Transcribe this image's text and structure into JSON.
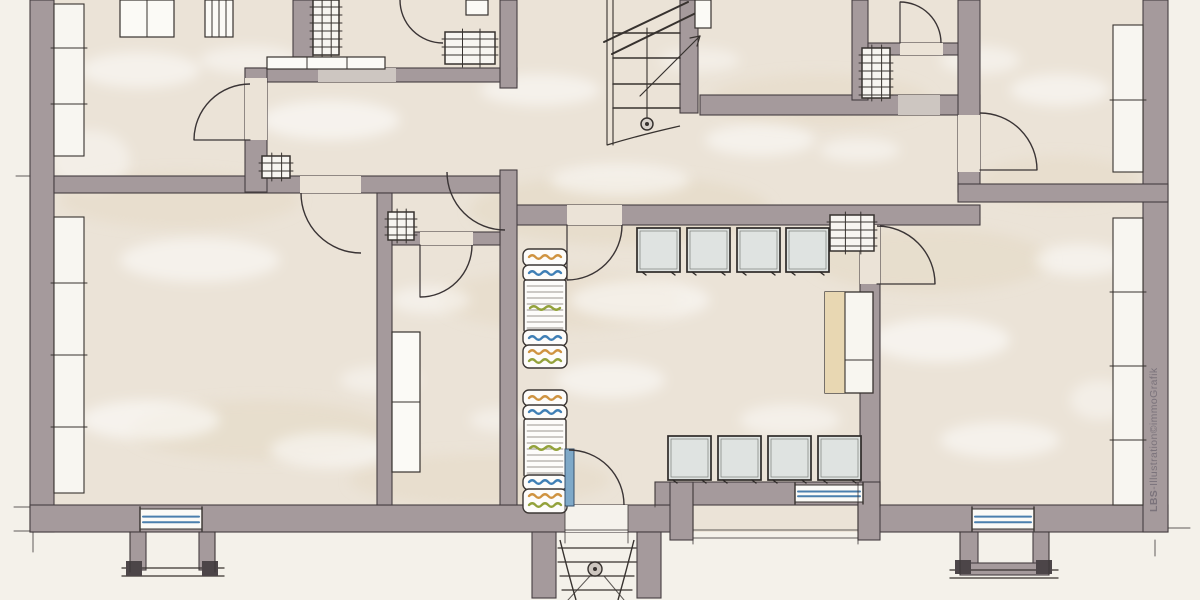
{
  "watermark": {
    "bold": "LBS",
    "rest": "-Illustration©immoGrafik",
    "color": "#7b737b"
  },
  "palette": {
    "paper": "#f4f1ea",
    "floor": "#ebe3d7",
    "floor_below": "#f5f2ec",
    "wall": "#a59a9c",
    "wall_edge": "#453e41",
    "line": "#37322f",
    "opening_light": "#cdc6c1",
    "window_fill": "#f8f6f1",
    "window_blue": "#4b7fae",
    "bed_orange": "#cf9340",
    "bed_blue": "#3f7fb5",
    "bed_green": "#93a23b",
    "cabinet": "#dfe3e1",
    "tan": "#e8d7b2",
    "patch_white": "#ffffff",
    "patch_tan": "#e3d7c1",
    "cap": "#4c4548"
  },
  "plan": {
    "interior": [
      30,
      0,
      1138,
      532
    ],
    "walls": [
      [
        30,
        0,
        24,
        532
      ],
      [
        30,
        505,
        663,
        27
      ],
      [
        858,
        505,
        310,
        27
      ],
      [
        655,
        482,
        225,
        23
      ],
      [
        1143,
        0,
        25,
        532
      ],
      [
        54,
        176,
        446,
        17
      ],
      [
        503,
        205,
        477,
        20
      ],
      [
        245,
        68,
        272,
        14
      ],
      [
        245,
        68,
        22,
        124
      ],
      [
        500,
        0,
        17,
        88
      ],
      [
        500,
        170,
        17,
        335
      ],
      [
        377,
        193,
        15,
        312
      ],
      [
        392,
        232,
        108,
        13
      ],
      [
        680,
        0,
        18,
        113
      ],
      [
        700,
        95,
        280,
        20
      ],
      [
        852,
        0,
        16,
        100
      ],
      [
        868,
        43,
        109,
        12
      ],
      [
        958,
        0,
        22,
        192
      ],
      [
        958,
        184,
        210,
        18
      ],
      [
        860,
        225,
        20,
        280
      ],
      [
        293,
        0,
        20,
        57
      ],
      [
        670,
        482,
        23,
        58
      ],
      [
        858,
        482,
        22,
        58
      ],
      [
        532,
        532,
        24,
        66
      ],
      [
        637,
        532,
        24,
        66
      ],
      [
        130,
        532,
        16,
        38
      ],
      [
        199,
        532,
        16,
        38
      ],
      [
        960,
        532,
        18,
        40
      ],
      [
        1033,
        532,
        16,
        40
      ],
      [
        960,
        563,
        89,
        12
      ]
    ],
    "exterior_count": 5,
    "openings": [
      {
        "r": [
          565,
          505,
          63,
          27
        ],
        "f": "below"
      },
      {
        "r": [
          300,
          176,
          61,
          17
        ],
        "f": "floor"
      },
      {
        "r": [
          567,
          205,
          55,
          20
        ],
        "f": "floor"
      },
      {
        "r": [
          245,
          78,
          22,
          62
        ],
        "f": "floor"
      },
      {
        "r": [
          898,
          95,
          42,
          20
        ],
        "f": "light"
      },
      {
        "r": [
          318,
          68,
          78,
          14
        ],
        "f": "light"
      },
      {
        "r": [
          900,
          43,
          43,
          12
        ],
        "f": "floor"
      },
      {
        "r": [
          958,
          115,
          22,
          57
        ],
        "f": "floor"
      },
      {
        "r": [
          860,
          225,
          20,
          59
        ],
        "f": "floor"
      },
      {
        "r": [
          420,
          232,
          53,
          13
        ],
        "f": "floor"
      }
    ],
    "side_windows": [
      {
        "r": [
          54,
          4,
          30,
          152
        ],
        "ticks": [
          48,
          104
        ]
      },
      {
        "r": [
          54,
          217,
          30,
          276
        ],
        "ticks": [
          283,
          355,
          427
        ]
      },
      {
        "r": [
          1113,
          25,
          30,
          147
        ],
        "ticks": [
          100
        ]
      },
      {
        "r": [
          1113,
          218,
          30,
          287
        ],
        "ticks": [
          292,
          366,
          440
        ]
      }
    ],
    "bottom_windows": [
      [
        140,
        509,
        62,
        20
      ],
      [
        795,
        485,
        68,
        17
      ],
      [
        972,
        509,
        62,
        20
      ]
    ],
    "doors": [
      {
        "c": [
          250,
          140
        ],
        "r": 56,
        "a0": 180,
        "a1": 270,
        "leaf": [
          250,
          140,
          194,
          140
        ]
      },
      {
        "c": [
          443,
          0
        ],
        "r": 43,
        "a0": 90,
        "a1": 180,
        "leaf": null
      },
      {
        "c": [
          361,
          193
        ],
        "r": 60,
        "a0": 90,
        "a1": 180,
        "leaf": null
      },
      {
        "c": [
          505,
          172
        ],
        "r": 58,
        "a0": 90,
        "a1": 180,
        "leaf": null
      },
      {
        "c": [
          569,
          505
        ],
        "r": 55,
        "a0": 270,
        "a1": 360,
        "leaf": null
      },
      {
        "c": [
          567,
          225
        ],
        "r": 55,
        "a0": 0,
        "a1": 90,
        "leaf": [
          567,
          225,
          567,
          280
        ]
      },
      {
        "c": [
          900,
          43
        ],
        "r": 41,
        "a0": 270,
        "a1": 360,
        "leaf": [
          900,
          43,
          900,
          2
        ]
      },
      {
        "c": [
          980,
          170
        ],
        "r": 57,
        "a0": 270,
        "a1": 360,
        "leaf": [
          980,
          170,
          1037,
          170
        ]
      },
      {
        "c": [
          877,
          284
        ],
        "r": 58,
        "a0": 270,
        "a1": 360,
        "leaf": [
          877,
          284,
          935,
          284
        ]
      },
      {
        "c": [
          420,
          245
        ],
        "r": 52,
        "a0": 0,
        "a1": 90,
        "leaf": [
          420,
          245,
          420,
          297
        ]
      }
    ],
    "entrance_leaf": [
      565,
      449,
      9,
      57
    ],
    "stairs": {
      "rails": [
        [
          607,
          0,
          607,
          145
        ],
        [
          613,
          0,
          613,
          145
        ],
        [
          647,
          28,
          647,
          118
        ]
      ],
      "tread_x": [
        613,
        680
      ],
      "treads": [
        33,
        58,
        84,
        108
      ],
      "breaks": [
        [
          604,
          42,
          688,
          2
        ],
        [
          612,
          54,
          698,
          12
        ]
      ],
      "arrow": [
        640,
        96,
        700,
        36
      ],
      "arrow_head": [
        [
          700,
          36,
          690,
          38
        ],
        [
          700,
          36,
          697,
          46
        ]
      ],
      "newel": [
        647,
        124,
        6
      ],
      "curve": "M607,145 Q640,135 680,126"
    },
    "porch": {
      "treads": [
        [
          558,
          548,
          636,
          548
        ],
        [
          558,
          562,
          636,
          562
        ],
        [
          560,
          576,
          634,
          576
        ],
        [
          562,
          590,
          632,
          590
        ]
      ],
      "rails": [
        "M560,540 Q568,572 576,600",
        "M634,540 Q626,572 618,600"
      ],
      "extra": [
        [
          590,
          576,
          568,
          600
        ],
        [
          604,
          576,
          624,
          600
        ]
      ],
      "post": [
        595,
        569,
        7
      ]
    },
    "bays": {
      "left": {
        "lines": [
          [
            122,
            568,
            224,
            568
          ],
          [
            122,
            576,
            224,
            576
          ]
        ],
        "caps": [
          [
            126,
            561,
            16,
            15
          ],
          [
            202,
            561,
            16,
            15
          ]
        ]
      },
      "right": {
        "lines": [
          [
            950,
            570,
            1058,
            570
          ],
          [
            950,
            578,
            1058,
            578
          ]
        ],
        "caps": [
          [
            955,
            560,
            16,
            14
          ],
          [
            1036,
            560,
            16,
            14
          ]
        ]
      }
    },
    "beds": [
      {
        "r": [
          523,
          249,
          44,
          17
        ],
        "t": "p",
        "w": [
          [
            "o",
            257
          ]
        ]
      },
      {
        "r": [
          523,
          265,
          44,
          16
        ],
        "t": "p",
        "w": [
          [
            "b",
            273
          ]
        ]
      },
      {
        "r": [
          524,
          280,
          42,
          52
        ],
        "t": "m",
        "w": [
          [
            "g",
            308
          ]
        ]
      },
      {
        "r": [
          523,
          330,
          44,
          16
        ],
        "t": "p",
        "w": [
          [
            "b",
            338
          ]
        ]
      },
      {
        "r": [
          523,
          345,
          44,
          23
        ],
        "t": "p",
        "w": [
          [
            "o",
            352
          ],
          [
            "g",
            361
          ]
        ]
      },
      {
        "r": [
          523,
          390,
          44,
          16
        ],
        "t": "p",
        "w": [
          [
            "o",
            398
          ]
        ]
      },
      {
        "r": [
          523,
          405,
          44,
          15
        ],
        "t": "p",
        "w": [
          [
            "b",
            412
          ]
        ]
      },
      {
        "r": [
          524,
          419,
          42,
          58
        ],
        "t": "m",
        "w": [
          [
            "g",
            448
          ]
        ]
      },
      {
        "r": [
          523,
          475,
          44,
          15
        ],
        "t": "p",
        "w": [
          [
            "b",
            482
          ]
        ]
      },
      {
        "r": [
          523,
          489,
          44,
          24
        ],
        "t": "p",
        "w": [
          [
            "o",
            496
          ],
          [
            "g",
            505
          ]
        ]
      }
    ],
    "cabinets": {
      "size": [
        43,
        44
      ],
      "upper": [
        [
          637,
          228
        ],
        [
          687,
          228
        ],
        [
          737,
          228
        ],
        [
          786,
          228
        ]
      ],
      "lower": [
        [
          668,
          436
        ],
        [
          718,
          436
        ],
        [
          768,
          436
        ],
        [
          818,
          436
        ]
      ]
    },
    "tall_cabinet": {
      "r": [
        825,
        292,
        48,
        101
      ],
      "tan": [
        825,
        292,
        20,
        101
      ],
      "divider": [
        845,
        292,
        845,
        393
      ],
      "shelf": [
        845,
        360,
        873,
        360
      ]
    },
    "closets": [
      {
        "r": [
          120,
          0,
          54,
          37
        ],
        "div": [
          [
            147,
            0,
            147,
            37
          ]
        ]
      },
      {
        "r": [
          205,
          0,
          28,
          37
        ],
        "div": [
          [
            212,
            0,
            212,
            37
          ],
          [
            219,
            0,
            219,
            37
          ],
          [
            226,
            0,
            226,
            37
          ]
        ]
      },
      {
        "r": [
          267,
          57,
          118,
          12
        ],
        "div": [
          [
            307,
            57,
            307,
            69
          ],
          [
            347,
            57,
            347,
            69
          ]
        ]
      },
      {
        "r": [
          466,
          0,
          22,
          15
        ],
        "div": []
      },
      {
        "r": [
          695,
          0,
          16,
          28
        ],
        "div": []
      },
      {
        "r": [
          392,
          332,
          28,
          140
        ],
        "div": [
          [
            392,
            402,
            420,
            402
          ]
        ]
      }
    ],
    "chimneys": [
      [
        388,
        212,
        26,
        28
      ],
      [
        262,
        156,
        28,
        22
      ],
      [
        445,
        32,
        50,
        32
      ],
      [
        830,
        215,
        44,
        36
      ],
      [
        862,
        48,
        28,
        50
      ],
      [
        313,
        0,
        26,
        55
      ]
    ],
    "sketch_lines": [
      [
        14,
        507,
        30,
        507
      ],
      [
        14,
        531,
        30,
        531
      ],
      [
        33,
        532,
        33,
        552
      ],
      [
        16,
        176,
        30,
        176
      ],
      [
        565,
        505,
        565,
        543
      ],
      [
        628,
        505,
        628,
        543
      ],
      [
        565,
        530,
        628,
        530
      ],
      [
        693,
        484,
        693,
        544
      ],
      [
        858,
        484,
        858,
        544
      ],
      [
        693,
        530,
        858,
        530
      ],
      [
        693,
        538,
        858,
        538
      ],
      [
        655,
        482,
        655,
        507
      ],
      [
        880,
        482,
        880,
        507
      ],
      [
        130,
        532,
        130,
        572
      ],
      [
        215,
        532,
        215,
        572
      ],
      [
        960,
        532,
        960,
        575
      ],
      [
        1049,
        532,
        1049,
        575
      ],
      [
        1168,
        528,
        1190,
        528
      ],
      [
        1155,
        540,
        1155,
        556
      ]
    ],
    "patches": {
      "white": [
        [
          140,
          70,
          60,
          18,
          0.5
        ],
        [
          330,
          120,
          70,
          20,
          0.55
        ],
        [
          540,
          90,
          60,
          16,
          0.5
        ],
        [
          760,
          140,
          55,
          16,
          0.5
        ],
        [
          1060,
          90,
          50,
          16,
          0.5
        ],
        [
          200,
          260,
          80,
          22,
          0.5
        ],
        [
          430,
          300,
          40,
          14,
          0.45
        ],
        [
          640,
          300,
          70,
          20,
          0.5
        ],
        [
          940,
          340,
          70,
          22,
          0.55
        ],
        [
          1080,
          260,
          45,
          16,
          0.5
        ],
        [
          150,
          420,
          70,
          20,
          0.55
        ],
        [
          330,
          450,
          60,
          18,
          0.5
        ],
        [
          610,
          380,
          55,
          18,
          0.5
        ],
        [
          790,
          420,
          50,
          16,
          0.45
        ],
        [
          1000,
          440,
          60,
          18,
          0.5
        ],
        [
          90,
          160,
          40,
          30,
          0.4
        ],
        [
          620,
          180,
          70,
          16,
          0.5
        ],
        [
          860,
          150,
          40,
          12,
          0.45
        ],
        [
          500,
          420,
          30,
          12,
          0.4
        ],
        [
          1100,
          400,
          30,
          20,
          0.4
        ],
        [
          250,
          60,
          50,
          14,
          0.45
        ],
        [
          700,
          60,
          40,
          12,
          0.4
        ],
        [
          980,
          60,
          40,
          14,
          0.45
        ],
        [
          380,
          380,
          40,
          14,
          0.4
        ]
      ],
      "tan": [
        [
          620,
          210,
          150,
          35,
          0.5
        ],
        [
          260,
          430,
          130,
          30,
          0.45
        ],
        [
          820,
          100,
          110,
          26,
          0.4
        ],
        [
          930,
          260,
          120,
          32,
          0.45
        ],
        [
          480,
          480,
          130,
          26,
          0.4
        ],
        [
          180,
          200,
          120,
          28,
          0.4
        ],
        [
          1060,
          180,
          80,
          24,
          0.4
        ],
        [
          560,
          300,
          120,
          30,
          0.4
        ]
      ]
    }
  }
}
